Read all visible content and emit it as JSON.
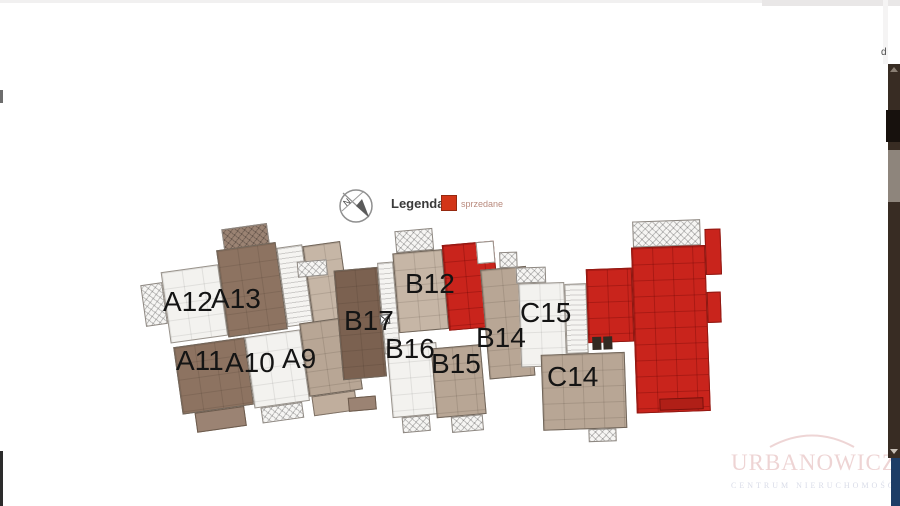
{
  "browser": {
    "edge_text": "d"
  },
  "legend": {
    "title": "Legenda:",
    "items": [
      {
        "label": "sprzedane",
        "color": "#d23517"
      }
    ]
  },
  "compass": {
    "letter": "N"
  },
  "plan": {
    "blocks": [
      {
        "name": "A",
        "units": [
          {
            "label": "A12"
          },
          {
            "label": "A13"
          },
          {
            "label": "A11"
          },
          {
            "label": "A10"
          },
          {
            "label": "A9"
          }
        ]
      },
      {
        "name": "B",
        "units": [
          {
            "label": "B17"
          },
          {
            "label": "B12"
          },
          {
            "label": "B16"
          },
          {
            "label": "B15"
          },
          {
            "label": "B14"
          }
        ]
      },
      {
        "name": "C",
        "units": [
          {
            "label": "C15"
          },
          {
            "label": "C14"
          }
        ]
      }
    ],
    "status_colors": {
      "sold": "#c9241c",
      "available_dark_brown": "#7b6150",
      "available_brown": "#8d7361",
      "available_tan": "#b8a695",
      "available_white": "#f3f2ef"
    }
  },
  "watermark": {
    "title": "URBANOWICZ",
    "subtitle": "CENTRUM NIERUCHOMOŚCI"
  },
  "scrollbar": {
    "track": "#382c23",
    "thumb": "#8e857c",
    "accent_blue": "#1d3d66"
  }
}
